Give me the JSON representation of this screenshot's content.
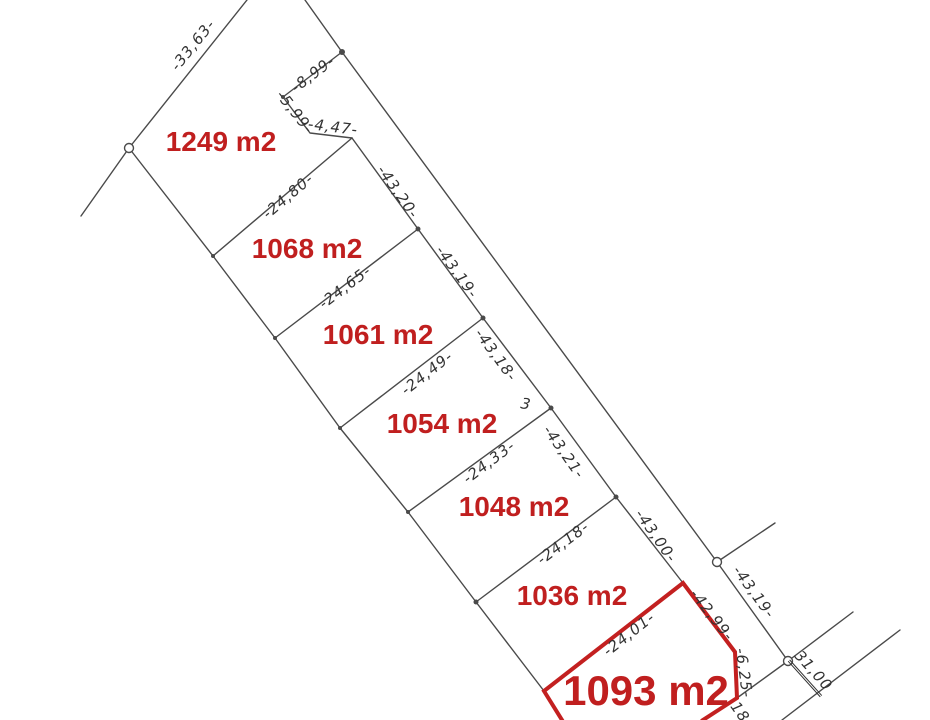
{
  "diagram": {
    "canvas": {
      "width": 930,
      "height": 720,
      "background": "#ffffff"
    },
    "colors": {
      "boundary_line": "#4a4a4a",
      "handwriting": "#333333",
      "parcel_text": "#c01f1f",
      "red_outline": "#c32020"
    },
    "parcels": [
      {
        "label": "1249 m2",
        "x": 221,
        "y": 142,
        "size": 28
      },
      {
        "label": "1068 m2",
        "x": 307,
        "y": 249,
        "size": 28
      },
      {
        "label": "1061 m2",
        "x": 378,
        "y": 335,
        "size": 28
      },
      {
        "label": "1054 m2",
        "x": 442,
        "y": 424,
        "size": 28
      },
      {
        "label": "1048 m2",
        "x": 514,
        "y": 507,
        "size": 28
      },
      {
        "label": "1036 m2",
        "x": 572,
        "y": 596,
        "size": 28
      },
      {
        "label": "1093 m2",
        "x": 646,
        "y": 691,
        "size": 42
      }
    ],
    "dimension_labels": [
      {
        "text": "-33,63-",
        "x": 193,
        "y": 45,
        "rot": -51
      },
      {
        "text": "-8,99-",
        "x": 313,
        "y": 74,
        "rot": -37
      },
      {
        "text": "-5,99-",
        "x": 295,
        "y": 112,
        "rot": 52
      },
      {
        "text": "-4,47-",
        "x": 333,
        "y": 127,
        "rot": 7
      },
      {
        "text": "-24,80-",
        "x": 288,
        "y": 196,
        "rot": -40
      },
      {
        "text": "-43,20-",
        "x": 398,
        "y": 192,
        "rot": 55
      },
      {
        "text": "-24,65-",
        "x": 345,
        "y": 287,
        "rot": -37
      },
      {
        "text": "-43,19-",
        "x": 457,
        "y": 272,
        "rot": 54
      },
      {
        "text": "-24,49-",
        "x": 427,
        "y": 373,
        "rot": -38
      },
      {
        "text": "-43,18-",
        "x": 496,
        "y": 355,
        "rot": 54
      },
      {
        "text": "3",
        "x": 526,
        "y": 404,
        "rot": 10
      },
      {
        "text": "-24,33-",
        "x": 489,
        "y": 462,
        "rot": -37
      },
      {
        "text": "-43,21-",
        "x": 564,
        "y": 452,
        "rot": 55
      },
      {
        "text": "-24,18-",
        "x": 563,
        "y": 543,
        "rot": -37
      },
      {
        "text": "-43,00-",
        "x": 656,
        "y": 536,
        "rot": 55
      },
      {
        "text": "-24,01-",
        "x": 629,
        "y": 634,
        "rot": -38
      },
      {
        "text": "-42,99-",
        "x": 712,
        "y": 615,
        "rot": 52
      },
      {
        "text": "-43,19-",
        "x": 754,
        "y": 592,
        "rot": 54
      },
      {
        "text": "-6,25-",
        "x": 744,
        "y": 673,
        "rot": 82
      },
      {
        "text": "31,00",
        "x": 812,
        "y": 672,
        "rot": 48,
        "underline": true
      },
      {
        "text": "18",
        "x": 740,
        "y": 712,
        "rot": 55
      }
    ],
    "boundary_lines": [
      {
        "name": "northwest-boundary",
        "points": [
          [
            81,
            216
          ],
          [
            129,
            148
          ],
          [
            247,
            0
          ]
        ]
      },
      {
        "name": "west-boundary",
        "points": [
          [
            129,
            148
          ],
          [
            213,
            256
          ],
          [
            275,
            338
          ],
          [
            340,
            428
          ],
          [
            408,
            512
          ],
          [
            476,
            602
          ],
          [
            544,
            691
          ]
        ]
      },
      {
        "name": "parcels-east-line",
        "points": [
          [
            352,
            138
          ],
          [
            418,
            229
          ],
          [
            483,
            318
          ],
          [
            551,
            408
          ],
          [
            616,
            497
          ],
          [
            683,
            583
          ]
        ]
      },
      {
        "name": "road-west-line",
        "points": [
          [
            305,
            0
          ],
          [
            342,
            52
          ],
          [
            717,
            562
          ],
          [
            788,
            661
          ],
          [
            737,
            698
          ]
        ]
      },
      {
        "name": "notch-lines",
        "points": [
          [
            342,
            52
          ],
          [
            283,
            97
          ],
          [
            310,
            133
          ],
          [
            352,
            138
          ]
        ]
      },
      {
        "name": "separator-1249-1068",
        "points": [
          [
            213,
            256
          ],
          [
            352,
            138
          ]
        ]
      },
      {
        "name": "separator-1068-1061",
        "points": [
          [
            275,
            338
          ],
          [
            418,
            229
          ]
        ]
      },
      {
        "name": "separator-1061-1054",
        "points": [
          [
            340,
            428
          ],
          [
            483,
            318
          ]
        ]
      },
      {
        "name": "separator-1054-1048",
        "points": [
          [
            408,
            512
          ],
          [
            551,
            408
          ]
        ]
      },
      {
        "name": "separator-1048-1036",
        "points": [
          [
            476,
            602
          ],
          [
            616,
            497
          ]
        ]
      },
      {
        "name": "spur-at-circle-1",
        "points": [
          [
            717,
            562
          ],
          [
            775,
            523
          ]
        ]
      },
      {
        "name": "spur-at-circle-2",
        "points": [
          [
            788,
            661
          ],
          [
            853,
            612
          ]
        ]
      },
      {
        "name": "east-side-lot-line",
        "points": [
          [
            900,
            630
          ],
          [
            782,
            720
          ]
        ]
      }
    ],
    "red_outline_points": [
      [
        562,
        720
      ],
      [
        544,
        691
      ],
      [
        683,
        583
      ],
      [
        735,
        652
      ],
      [
        737,
        698
      ],
      [
        703,
        720
      ]
    ],
    "open_circles": [
      {
        "x": 129,
        "y": 148
      },
      {
        "x": 717,
        "y": 562
      },
      {
        "x": 788,
        "y": 661
      }
    ],
    "dots": [
      {
        "x": 342,
        "y": 52,
        "r": 3
      },
      {
        "x": 418,
        "y": 229,
        "r": 2.5
      },
      {
        "x": 483,
        "y": 318,
        "r": 2.5
      },
      {
        "x": 551,
        "y": 408,
        "r": 2.5
      },
      {
        "x": 616,
        "y": 497,
        "r": 2.5
      },
      {
        "x": 476,
        "y": 602,
        "r": 2.5
      },
      {
        "x": 213,
        "y": 256,
        "r": 2
      },
      {
        "x": 275,
        "y": 338,
        "r": 2
      },
      {
        "x": 340,
        "y": 428,
        "r": 2
      },
      {
        "x": 408,
        "y": 512,
        "r": 2
      },
      {
        "x": 283,
        "y": 97,
        "r": 2
      }
    ]
  }
}
